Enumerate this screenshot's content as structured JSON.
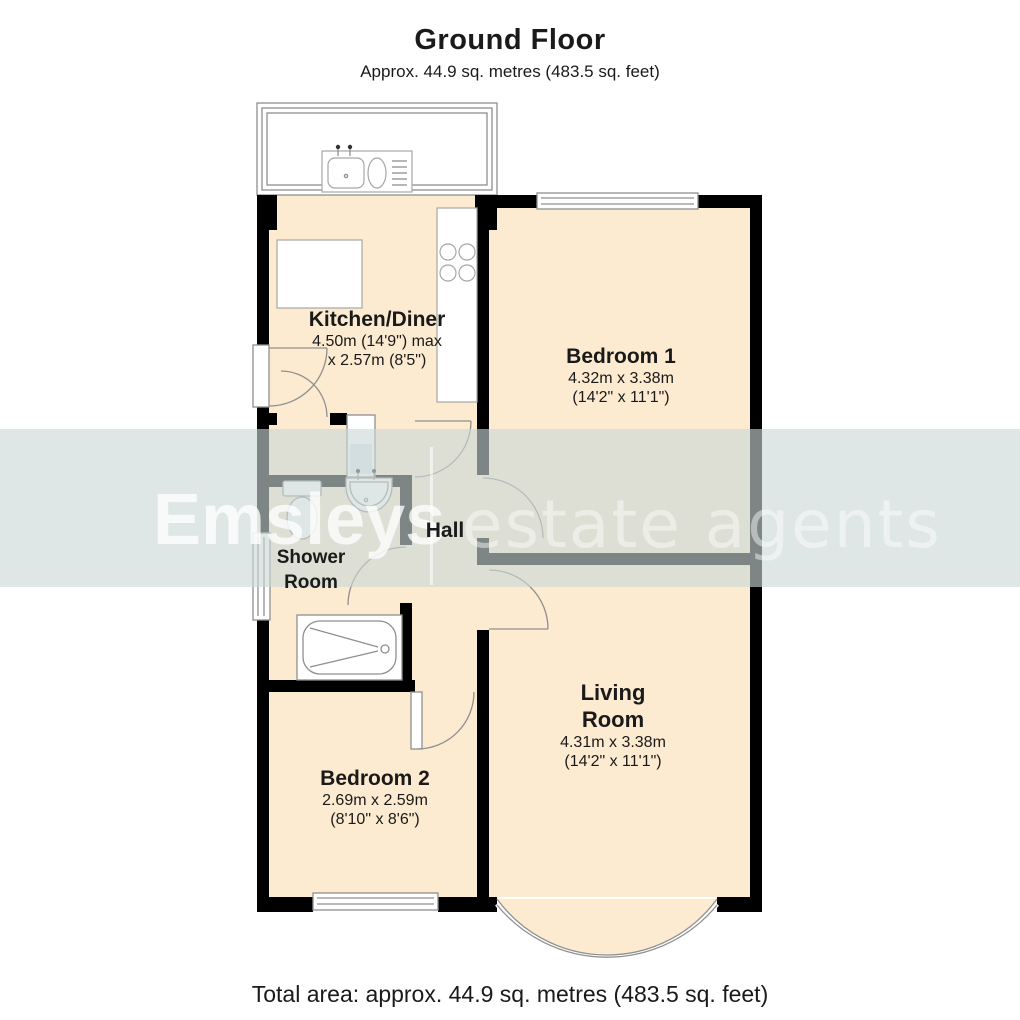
{
  "title": {
    "heading": "Ground Floor",
    "subtitle": "Approx. 44.9 sq. metres (483.5 sq. feet)"
  },
  "footer": {
    "total_area": "Total area: approx. 44.9 sq. metres (483.5 sq. feet)"
  },
  "watermark": {
    "brand": "Emsleys",
    "separator": "",
    "tagline": "estate agents"
  },
  "rooms": {
    "kitchen": {
      "name": "Kitchen/Diner",
      "dim_line1": "4.50m (14'9\") max",
      "dim_line2": "x 2.57m (8'5\")"
    },
    "bedroom1": {
      "name": "Bedroom 1",
      "dim_line1": "4.32m x 3.38m",
      "dim_line2": "(14'2\" x 11'1\")"
    },
    "hall": {
      "name": "Hall"
    },
    "shower": {
      "name_line1": "Shower",
      "name_line2": "Room"
    },
    "living": {
      "name_line1": "Living",
      "name_line2": "Room",
      "dim_line1": "4.31m x 3.38m",
      "dim_line2": "(14'2\" x 11'1\")"
    },
    "bedroom2": {
      "name": "Bedroom 2",
      "dim_line1": "2.69m x 2.59m",
      "dim_line2": "(8'10\" x 8'6\")"
    }
  },
  "fixtures": [
    "sink-icon",
    "hob-icon",
    "counter",
    "toilet-icon",
    "basin-icon",
    "shower-cubicle-icon",
    "bathtub-icon",
    "bay-window",
    "windows",
    "door-swing-arcs"
  ],
  "colors": {
    "floor": "#fcebd0",
    "wall": "#000000",
    "line": "#8f8f8f",
    "fixture": "#ffffff",
    "band": "rgba(203,216,214,0.62)",
    "watermark_text": "#ffffff",
    "ink": "#1a1a1a"
  }
}
